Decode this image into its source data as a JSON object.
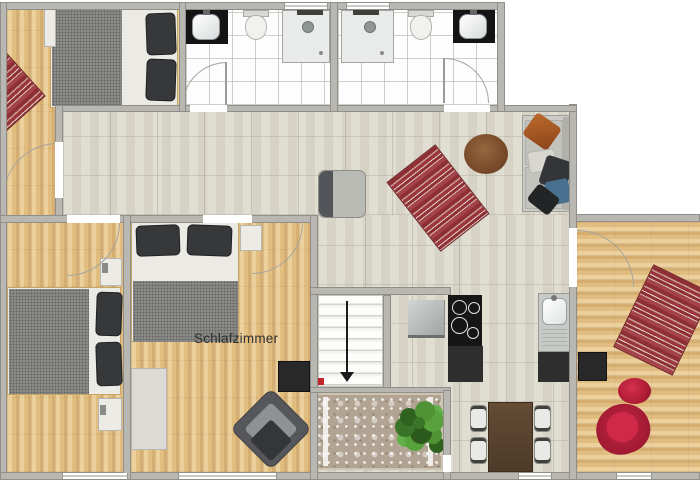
{
  "meta": {
    "kind": "floor-plan-screenshot",
    "canvas": {
      "width": 700,
      "height": 485
    }
  },
  "labels": {
    "schlafzimmer": "Schlafzimmer"
  },
  "rooms": [
    {
      "id": "bedroom-top-left",
      "floor": "wood",
      "furniture": [
        "double-bed",
        "nightstand",
        "striped-rug"
      ]
    },
    {
      "id": "bathroom-left",
      "floor": "white-tile",
      "fixtures": [
        "washbasin",
        "toilet",
        "shower",
        "door"
      ]
    },
    {
      "id": "bathroom-right",
      "floor": "white-tile",
      "fixtures": [
        "shower",
        "toilet",
        "washbasin",
        "door"
      ]
    },
    {
      "id": "hallway",
      "floor": "stone-tile"
    },
    {
      "id": "living-area",
      "floor": "stone-tile",
      "furniture": [
        "armchair",
        "striped-rug",
        "round-pouf",
        "sofa"
      ]
    },
    {
      "id": "bedroom-bottom-left",
      "floor": "wood",
      "furniture": [
        "double-bed",
        "nightstand",
        "nightstand"
      ]
    },
    {
      "id": "schlafzimmer",
      "floor": "wood",
      "furniture": [
        "double-bed",
        "nightstand",
        "desk",
        "tv-board",
        "armchair"
      ]
    },
    {
      "id": "stair-hall",
      "features": [
        "staircase",
        "direction-arrow-down",
        "red-marker"
      ]
    },
    {
      "id": "kitchen",
      "fixtures": [
        "steel-counter",
        "cooktop-4-burners",
        "kitchen-sink",
        "base-cabinets"
      ]
    },
    {
      "id": "dining-area",
      "furniture": [
        "dining-table",
        "chair",
        "chair",
        "chair",
        "chair"
      ]
    },
    {
      "id": "carpet-room",
      "furniture": [
        "ornamental-rug",
        "potted-plant"
      ]
    },
    {
      "id": "room-right",
      "floor": "wood",
      "furniture": [
        "tv-board",
        "striped-rug",
        "red-pouf",
        "red-armchair"
      ]
    }
  ],
  "stairs": {
    "direction": "down",
    "marker_color": "#c4242b"
  },
  "colors": {
    "wall": "#b8b7b2",
    "wood_floor": "#e2bd80",
    "stone_tile": "#dcd9cc",
    "bath_tile": "#fdfdfd",
    "rug_red": "#8e2f36",
    "rug_ornamental": "#b2a492",
    "duvet_gray": "#8a8b88",
    "pillow_dark": "#36383a",
    "sofa_gray": "#cbcbc5",
    "pillow_orange": "#aa561e",
    "pillow_blue": "#47708e",
    "pouf_brown": "#7c4d2b",
    "red_chair": "#b01c35",
    "table_brown": "#5c4531",
    "plant_green": "#468631",
    "appliance_black": "#141414"
  }
}
